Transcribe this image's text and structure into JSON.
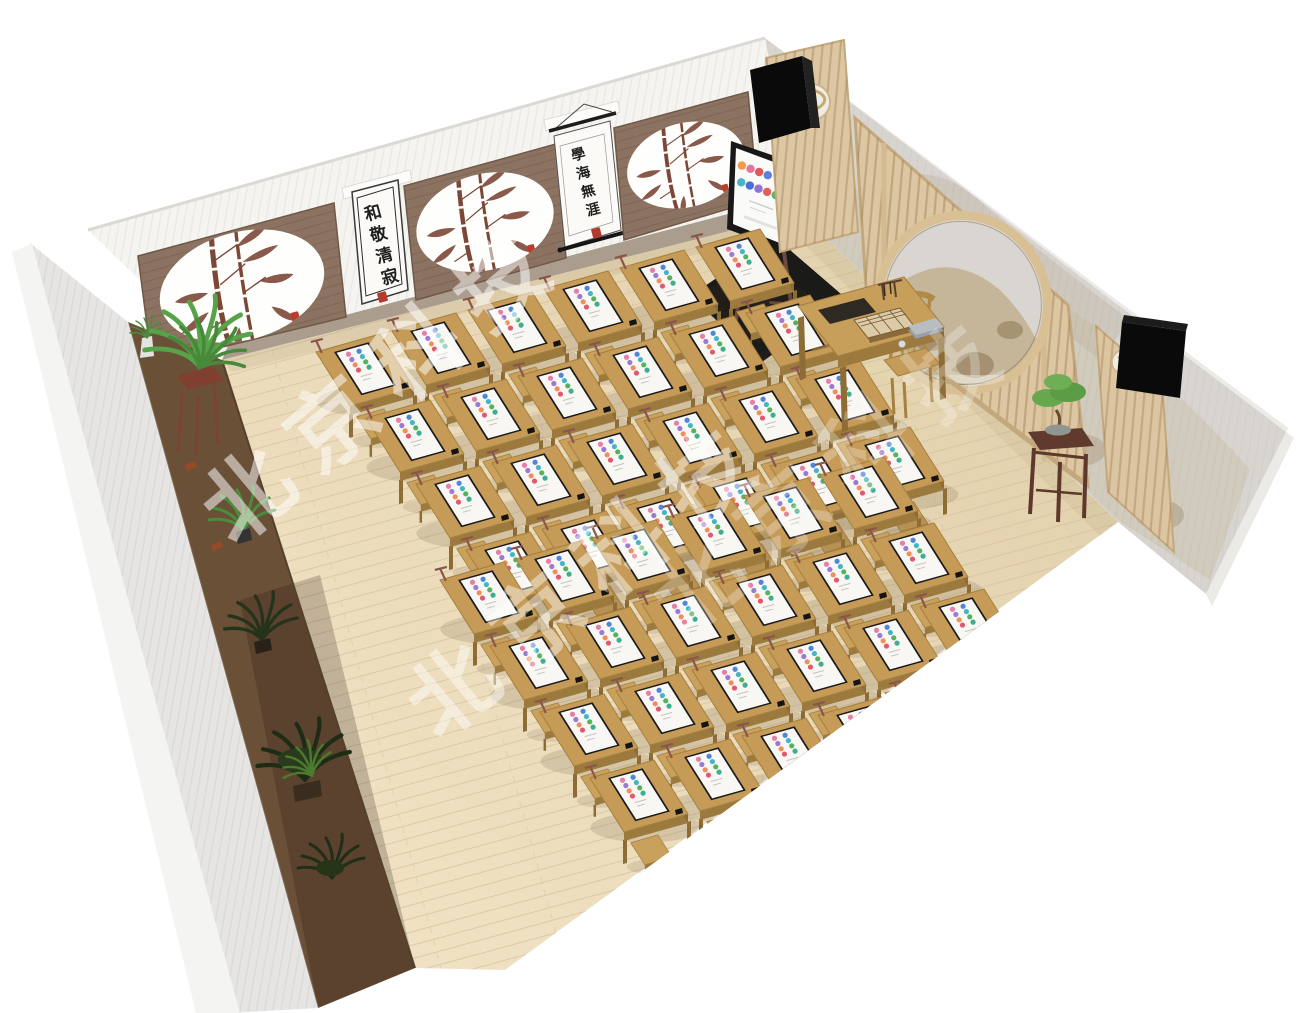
{
  "watermark": {
    "text": "北京科技",
    "color": "rgba(255,255,255,0.52)"
  },
  "wall_scrolls": {
    "scroll_small_framed": "和敬清寂",
    "scroll_hanging": "學海無涯"
  },
  "icons": {
    "partition_logo": "cloud-swirl-logo",
    "bamboo_medallion": "ink-bamboo-painting"
  },
  "tv": {
    "icon_rows": [
      [
        "#ef9a4d",
        "#e8739f",
        "#e05a5a",
        "#5b82d8"
      ],
      [
        "#49b4c6",
        "#4a6fd0",
        "#9272d2",
        "#df5f5f",
        "#5cb266"
      ]
    ]
  },
  "desk_screens": {
    "icon_rows": [
      [
        "#e57fa8",
        "#9a7bd4",
        "#ef8f5a",
        "#e05a6f"
      ],
      [
        "#4f86d9",
        "#45b5c4",
        "#57b25e",
        "#3fae8f"
      ]
    ]
  },
  "room": {
    "desk_count_estimate": 48,
    "desk_blocks": [
      {
        "origin": [
          316,
          352
        ],
        "col_step": [
          76,
          -21
        ],
        "row_step": [
          50,
          66
        ],
        "rows": 4,
        "cols": 6
      },
      {
        "origin": [
          440,
          580
        ],
        "col_step": [
          76,
          -21
        ],
        "row_step": [
          50,
          66
        ],
        "rows": 4,
        "cols": 6
      }
    ]
  },
  "colors": {
    "floor": "#e9dab9",
    "floor_plank": "#d6c19c",
    "desk_top": "#c59b57",
    "desk_side": "#9c7a3e",
    "desk_dark": "#8d6d35",
    "stool_top": "#c9a05c",
    "screen_face": "#f8f7f3",
    "bezel": "#1a1a1a",
    "wall": "#f5f4f1",
    "panel_wood": "#8c7260",
    "partition": "#ddc7a3",
    "mural_base": "#d8d5d1",
    "bench": "#6b5038",
    "speaker": "#0a0a0a"
  }
}
